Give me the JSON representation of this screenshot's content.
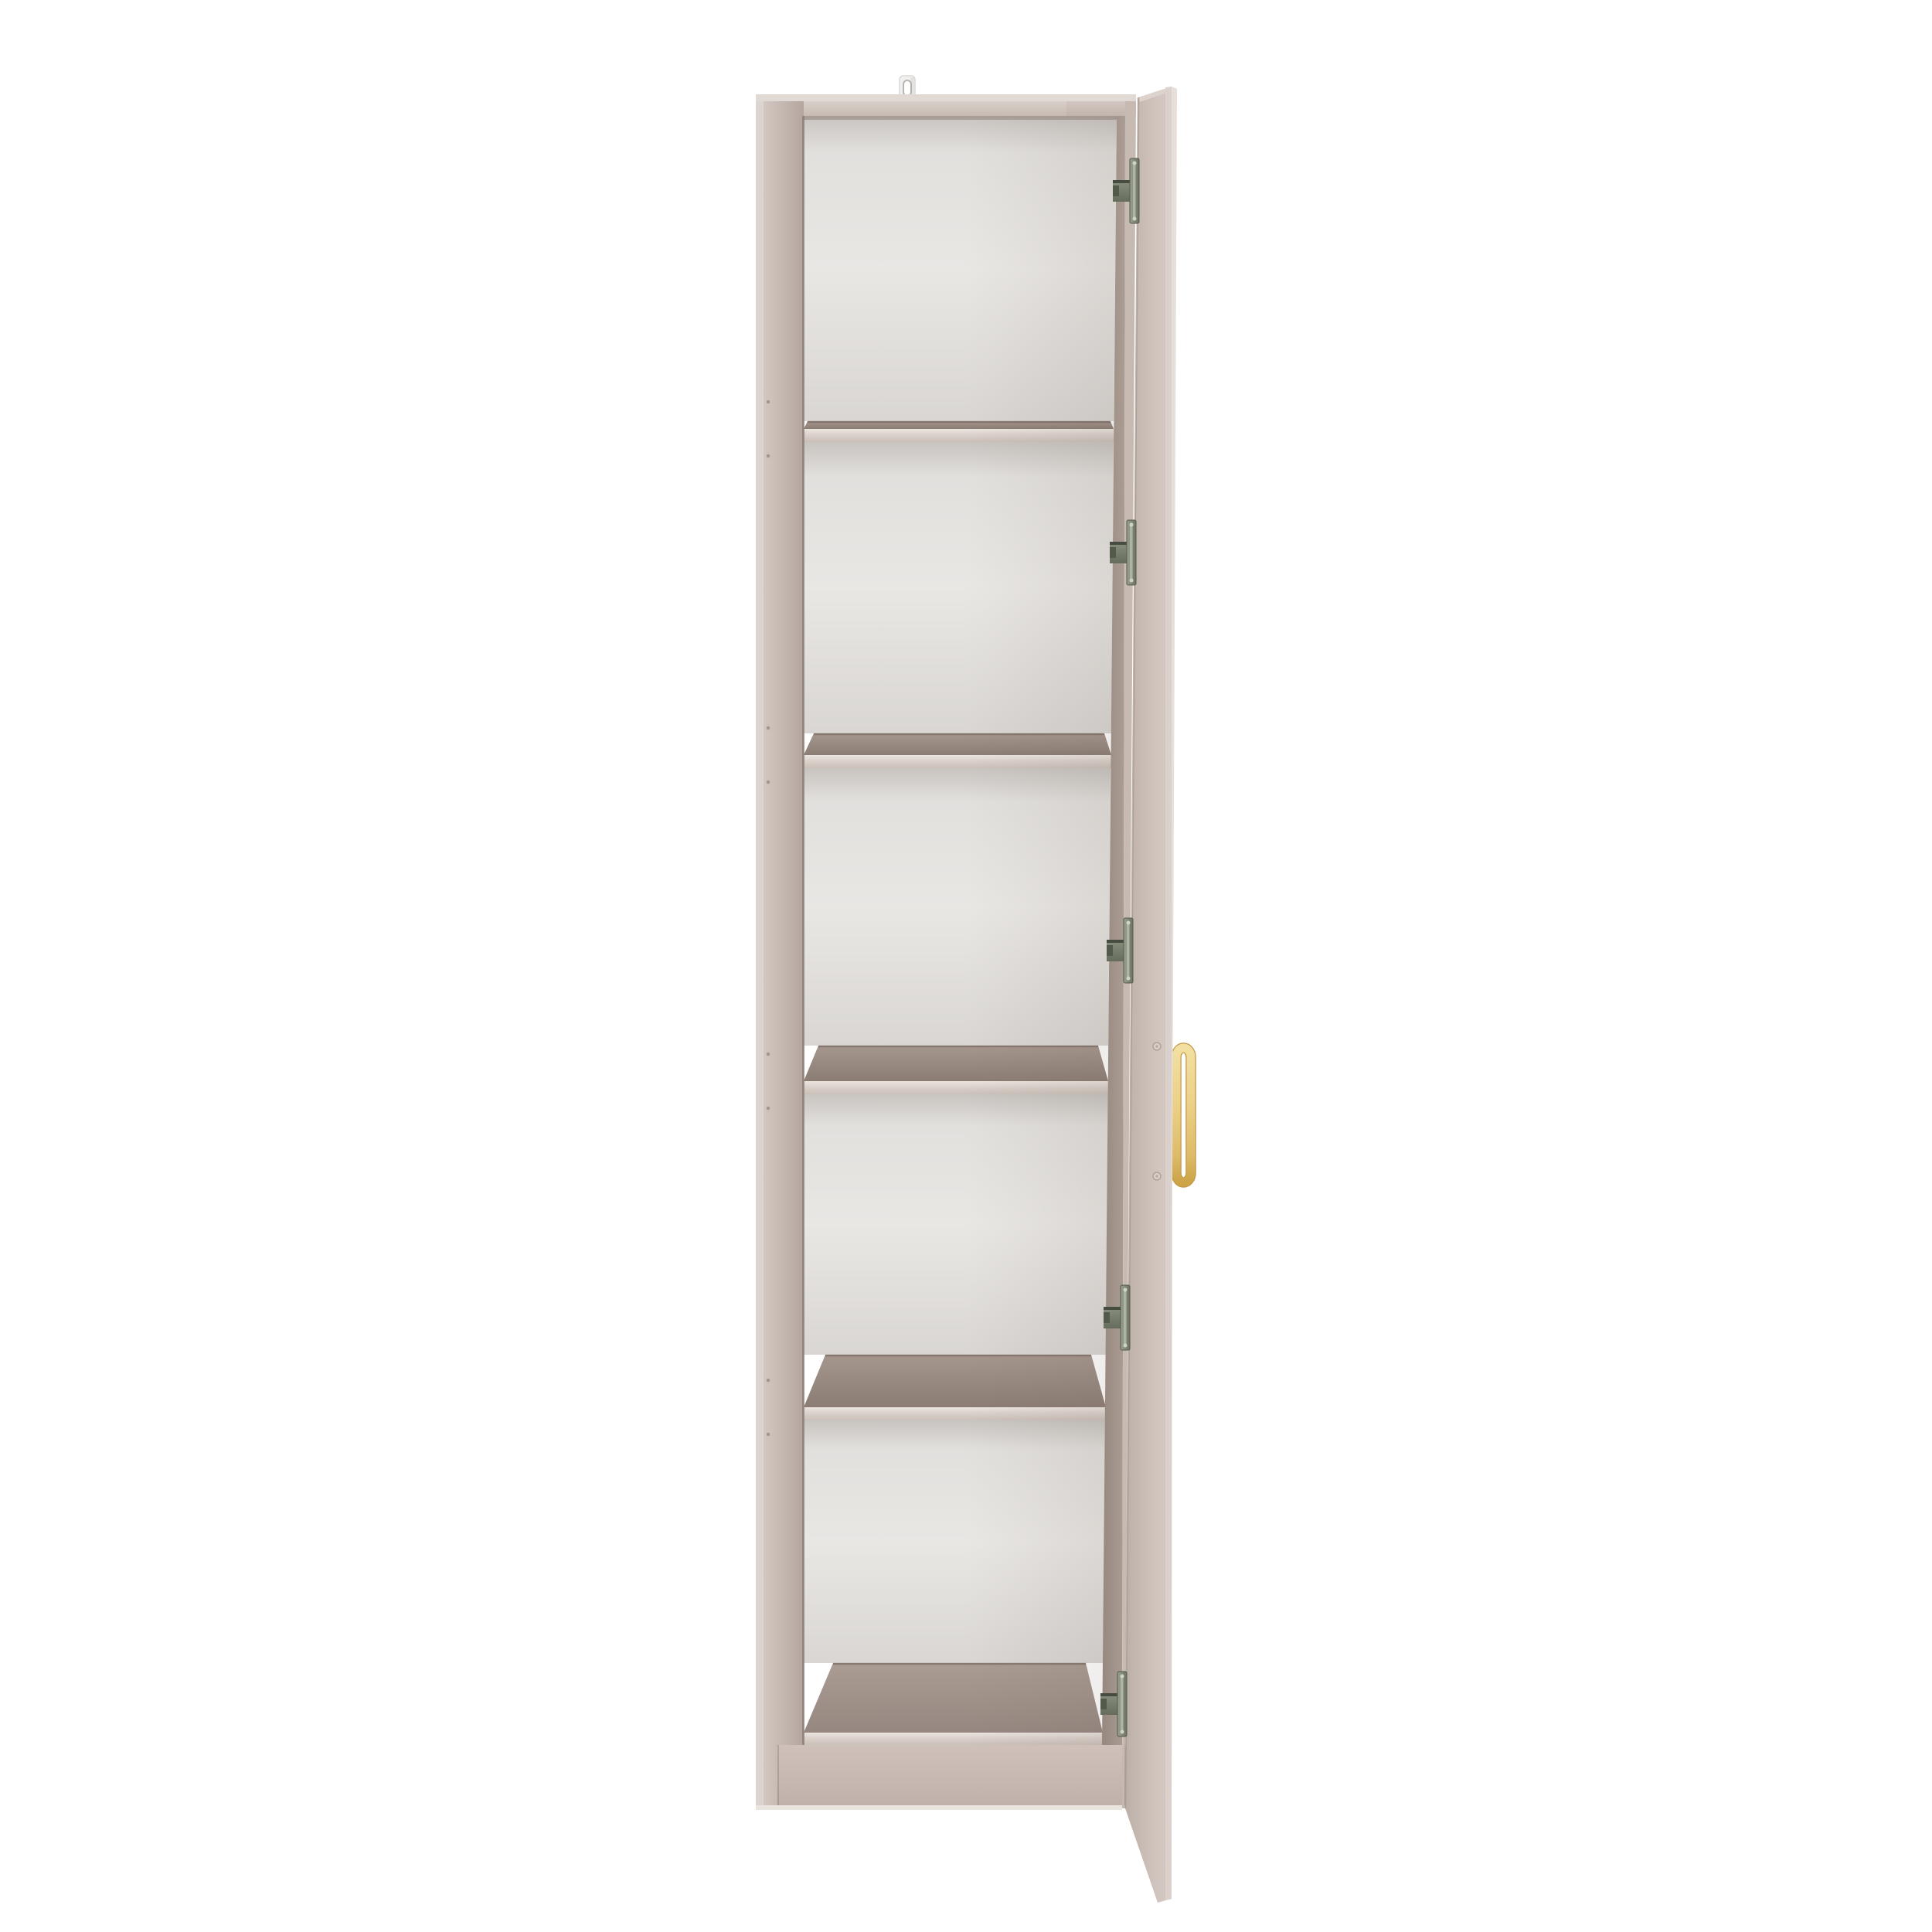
{
  "meta": {
    "description": "Product render: tall narrow storage cabinet with five open compartments, right-hand door open, brass D handle",
    "background": "#ffffff"
  },
  "product": {
    "type": "tall-cabinet",
    "compartments": 5,
    "shelves": 4,
    "hinges": 5,
    "door": {
      "position": "right",
      "state": "open"
    },
    "handle": {
      "finish": "brass",
      "shape": "d-bar"
    },
    "wall_bracket": {
      "present": true,
      "color": "white"
    }
  },
  "colors": {
    "bg": "#ffffff",
    "frame-edge-hi": "#e1d9d4",
    "frame-face-1": "#d8cfc9",
    "frame-face-2": "#c7bab3",
    "left-hi": "#dcd4cf",
    "left-light": "#d3c7c1",
    "left-dark": "#b4a69f",
    "seam-dark": "#87796f",
    "back-top": "#c8c4c0",
    "back-hi": "#e9e7e4",
    "back-mid": "#e2e0dd",
    "back-low": "#d9d6d3",
    "band-hi": "#a5968e",
    "band-lo": "#8b7c74",
    "strip-hi": "#ece5e0",
    "strip-mid": "#dcd3cd",
    "strip-lo": "#cbc0b9",
    "face-right-1": "#ab9c94",
    "face-right-2": "#97887f",
    "door-l": "#bcafa8",
    "door-m": "#c9bcb5",
    "door-r2": "#d3c7c1",
    "door-r": "#cfc2bc",
    "door-cap": "#dcd3cd",
    "door-edge": "#e7dfd9",
    "door-seam": "#a3958d",
    "plinth-1": "#cfc1ba",
    "plinth-2": "#c0b2ab",
    "floor-1": "#aa9b93",
    "floor-2": "#968780",
    "bottom-edge": "#eae4df",
    "gold-1": "#f2e0a2",
    "gold-2": "#eccf85",
    "gold-3": "#ddbb69",
    "gold-4": "#cda447",
    "gold-line": "#c19a48",
    "metal-1": "#9ba190",
    "metal-2": "#6d7363",
    "metal-3": "#545a4b",
    "metal-4": "#474c40",
    "metal-arm-1": "#8a9080",
    "metal-arm-2": "#666c5c",
    "metal-slot": "#b9bfb0",
    "metal-dot": "#cfd4c6",
    "bracket-fill": "#f2f1ef",
    "bracket-stroke": "#dbd9d6",
    "bracket-hole": "#b8b6b3",
    "pin-hole": "#9b8c84",
    "screw-fill": "#d9cec7",
    "screw-ring": "#a89a92",
    "screw-dot": "#b5a79f",
    "shadow-top": "#8e8077"
  }
}
